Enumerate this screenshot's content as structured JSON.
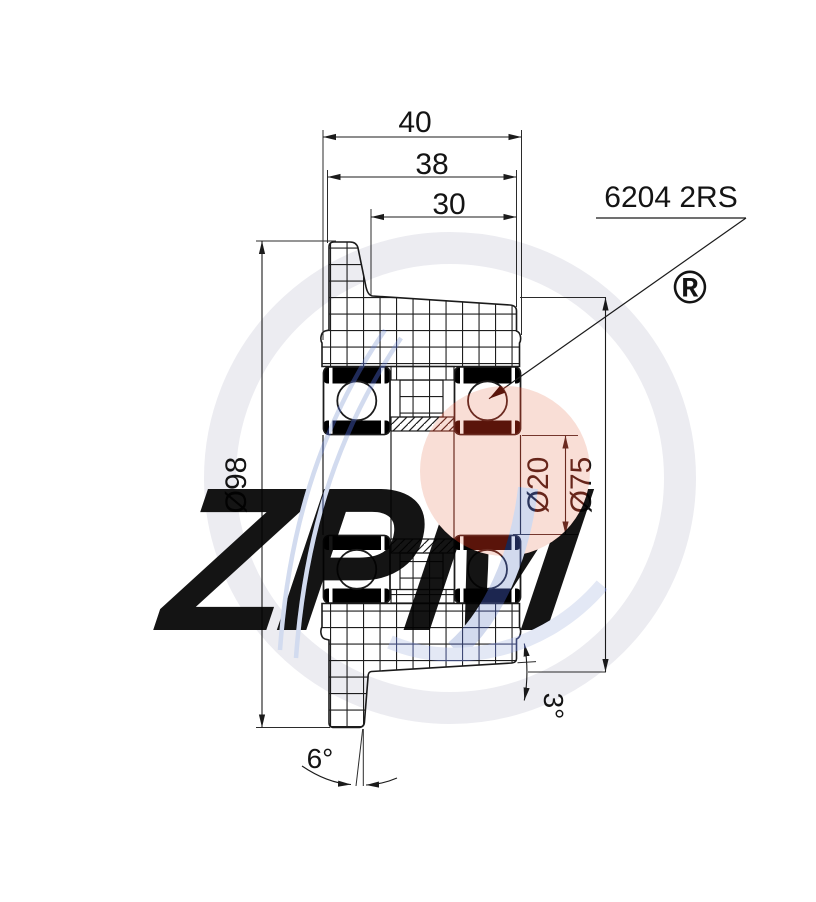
{
  "drawing": {
    "dimensions": {
      "overall_width": "40",
      "hub_width": "38",
      "recess_width": "30",
      "outer_diameter": "Ø98",
      "bore_diameter": "Ø20",
      "hub_diameter": "Ø75",
      "tread_taper_angle": "3°",
      "side_draft_angle": "6°"
    },
    "callouts": {
      "bearing_designation": "6204 2RS"
    },
    "watermark": {
      "logo_text": "ZPM",
      "registered_symbol": "®"
    },
    "colors": {
      "drawing_line": "#1b1b1b",
      "bearing_seal": "#000000",
      "watermark_gray": "#ececf1",
      "watermark_pink": "#f6dbd4",
      "watermark_red": "#5a140a",
      "watermark_blue_light": "#ccd4e6",
      "watermark_blue_dark": "#202b59"
    }
  }
}
